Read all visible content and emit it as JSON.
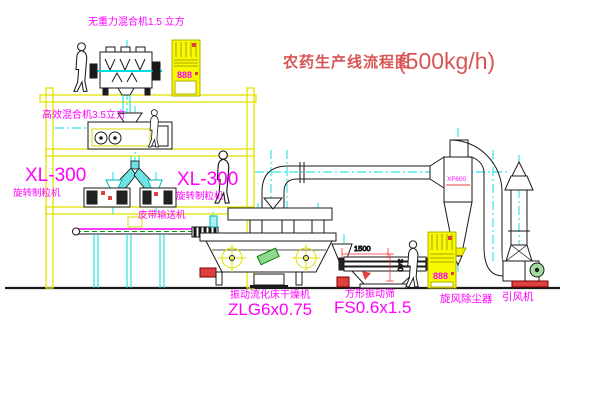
{
  "title": {
    "main": "农药生产线流程图",
    "capacity": "(500kg/h)"
  },
  "labels": {
    "top_mixer": "无重力混合机1.5 立方",
    "mid_mixer": "高效混合机3.5立方",
    "xl_left_model": "XL-300",
    "xl_left_name": "旋转制粒机",
    "xl_right_model": "XL-300",
    "xl_right_name": "旋转制粒机",
    "belt": "皮带输送机",
    "dryer_name": "振动流化床干燥机",
    "dryer_model": "ZLG6x0.75",
    "screen_name": "方形振动筛",
    "screen_model": "FS0.6x1.5",
    "cyclone": "旋风除尘器",
    "cyclone_tag": "XF600",
    "fan": "引风机"
  },
  "dimensions": {
    "screen_length": "1500",
    "screen_height": "340"
  },
  "cabinet": {
    "display": "888"
  },
  "colors": {
    "label_magenta": "#ff00ff",
    "title_red": "#d85555",
    "structure_yellow": "#e3e300",
    "pipe_cyan": "#00dcdc",
    "dimension_red": "#ff3030",
    "alert_red": "#e04040",
    "belt_green": "#00a000"
  }
}
